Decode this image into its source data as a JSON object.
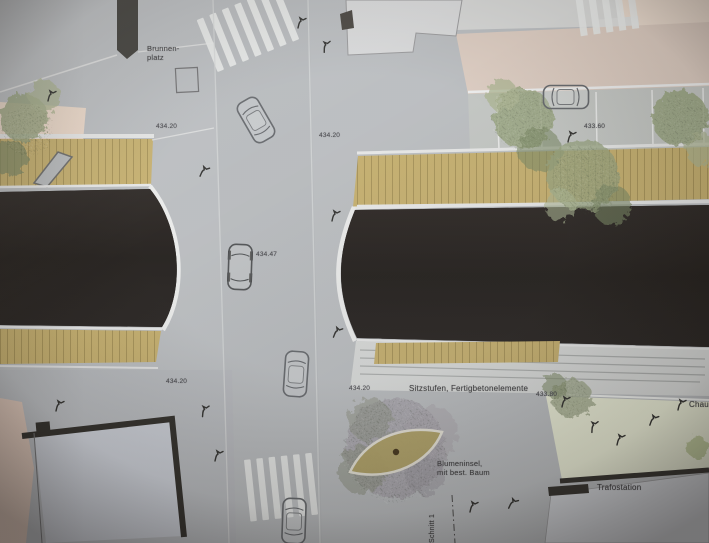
{
  "plan": {
    "labels": {
      "brunnenplatz_line1": "Brunnen-",
      "brunnenplatz_line2": "platz",
      "sitzstufen": "Sitzstufen, Fertigbetonelemente",
      "blumeninsel_line1": "Blumeninsel,",
      "blumeninsel_line2": "mit best. Baum",
      "trafostation": "Trafostation",
      "chaussee": "Chau",
      "schnitt": "Schnitt 1"
    },
    "elevations": {
      "plaza_top_left": "434.20",
      "street_top_right": "434.20",
      "parking_top_right": "433.60",
      "street_center": "434.47",
      "sidewalk_bottom_left": "434.20",
      "street_bottom_mid": "434.20",
      "seating_steps_right": "433.80"
    },
    "colors": {
      "asphalt_gray": "#b9bcbf",
      "dark_surface": "#221e1b",
      "timber_deck": "#c6ae67",
      "building_beige": "#dccbbf",
      "lawn_green": "#e9ecd4",
      "marking_white": "#e9eae9"
    }
  }
}
